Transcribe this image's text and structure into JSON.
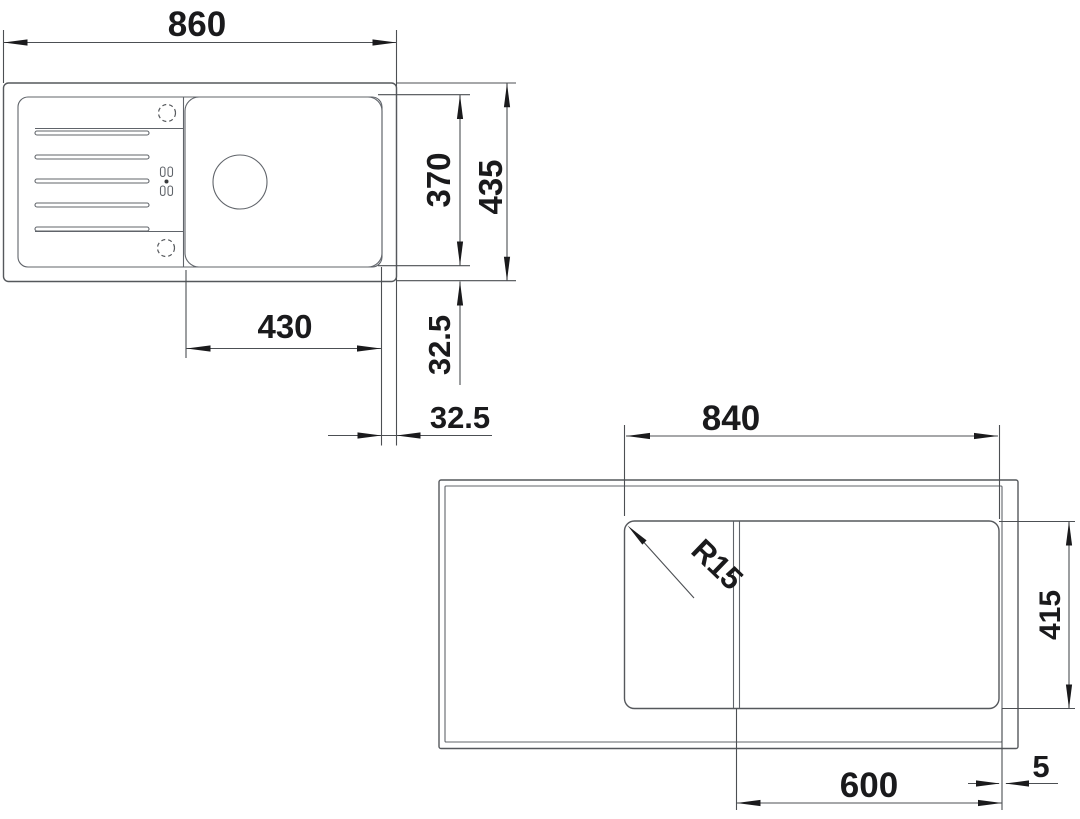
{
  "top_view": {
    "overall_width": "860",
    "overall_depth": "435",
    "bowl_depth": "370",
    "bowl_width": "430",
    "offset_bottom": "32.5",
    "offset_side": "32.5"
  },
  "cutout_view": {
    "width": "840",
    "depth": "415",
    "corner_radius": "R15",
    "base_width": "600",
    "edge_gap": "5"
  },
  "colors": {
    "line": "#55585c",
    "text": "#1a1a1c",
    "background": "#ffffff"
  }
}
